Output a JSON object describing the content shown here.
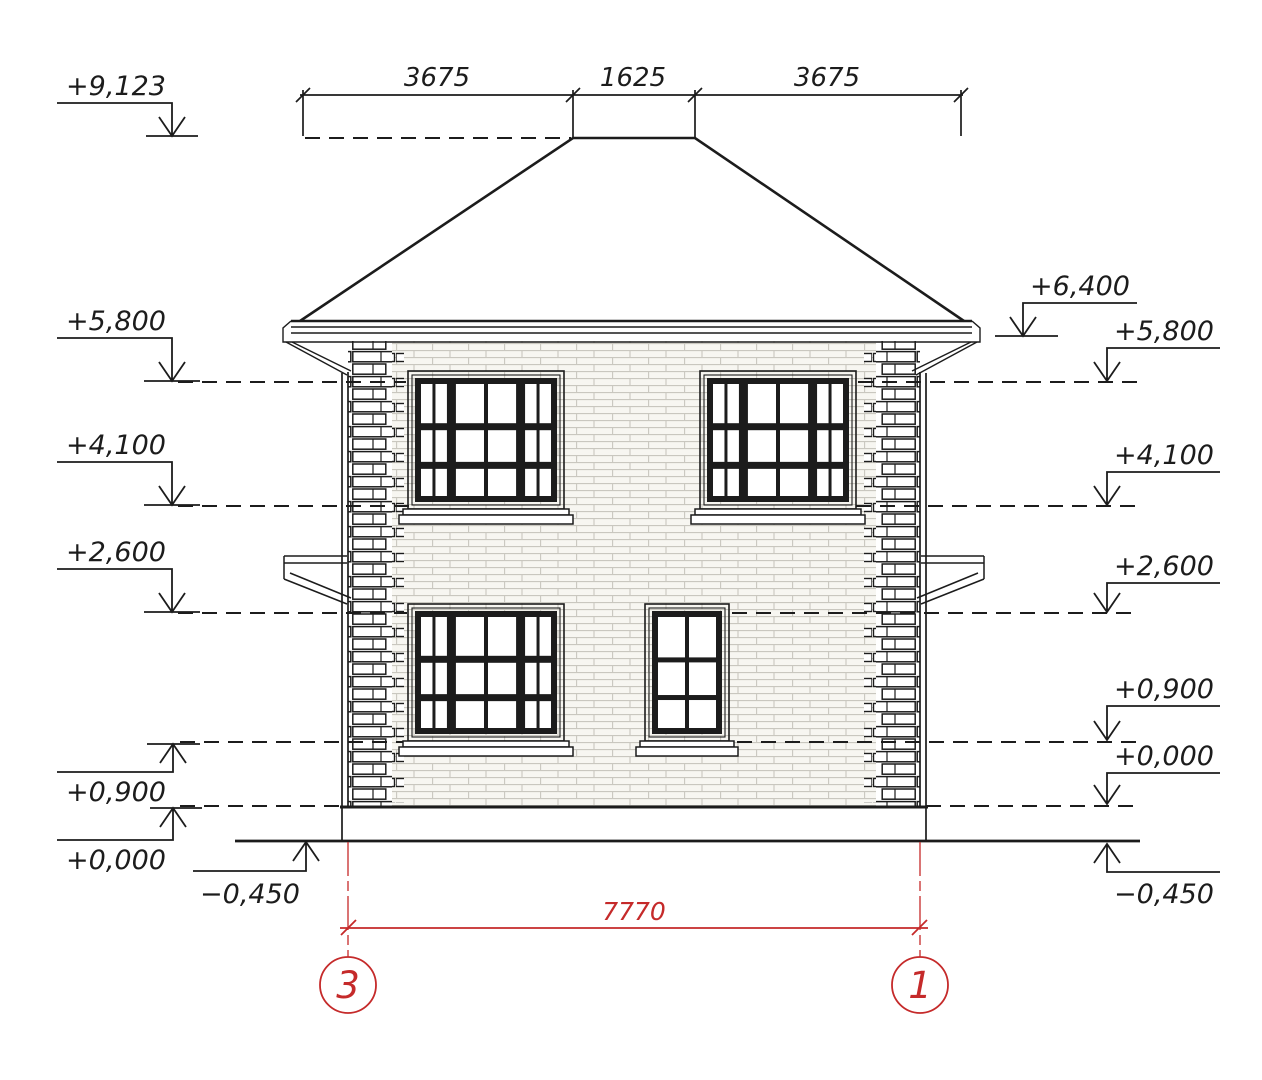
{
  "title": "House facade elevation between axes 3 and 1",
  "colors": {
    "line": "#1c1c1c",
    "accent_red": "#c52a2a",
    "wall_fill": "#f7f6f1",
    "mortar": "#c9c7bf"
  },
  "top_dimension_chain": {
    "segments": [
      "3675",
      "1625",
      "3675"
    ]
  },
  "bottom_dimension": {
    "value": "7770"
  },
  "axes": {
    "left_label": "3",
    "right_label": "1"
  },
  "levels_left": [
    {
      "label": "+9,123"
    },
    {
      "label": "+5,800"
    },
    {
      "label": "+4,100"
    },
    {
      "label": "+2,600"
    },
    {
      "label": "+0,900"
    },
    {
      "label": "+0,000"
    },
    {
      "label": "−0,450"
    }
  ],
  "levels_right": [
    {
      "label": "+6,400"
    },
    {
      "label": "+5,800"
    },
    {
      "label": "+4,100"
    },
    {
      "label": "+2,600"
    },
    {
      "label": "+0,900"
    },
    {
      "label": "+0,000"
    },
    {
      "label": "−0,450"
    }
  ]
}
